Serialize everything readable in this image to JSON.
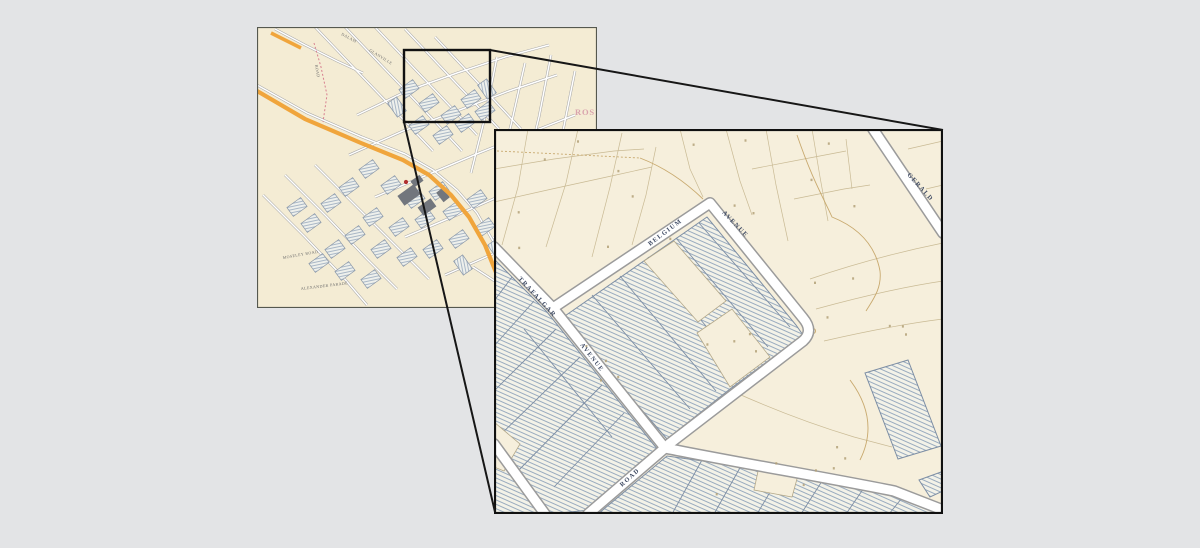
{
  "page": {
    "background_color": "#e3e4e6"
  },
  "overview_map": {
    "labels": {
      "region_pink": "ROS",
      "street_labels": [
        "MOSELEY ROAD",
        "ALEXANDER PARADE",
        "ROAD",
        "DALAM",
        "GLANVILLE"
      ]
    },
    "colors": {
      "paper": "#f4ecd4",
      "highway_orange": "#f0a53c",
      "hatch_blue": "#97a9bd",
      "boundary_pink": "#d77f8f",
      "pink_text": "#d9a3ad",
      "landmark_red": "#b03030"
    }
  },
  "detail_map": {
    "street_labels": {
      "trafalgar": "TRAFALGAR",
      "trafalgar_avenue": "AVENUE",
      "belgium": "BELGIUM",
      "belgium_avenue": "AVENUE",
      "gerald": "GERALD",
      "road": "ROAD"
    },
    "colors": {
      "paper": "#f6efdc",
      "parcel_line": "#c9ba94",
      "hatch_blue": "#8fa3bb",
      "hatch_outline": "#7d8ea4",
      "road_fill": "#ffffff",
      "road_casing": "#9b9b9b",
      "street_label": "#3e4a63",
      "track_tan": "#c8a96e"
    }
  },
  "callout": {
    "line_color": "#161616",
    "box_color": "#111111"
  }
}
